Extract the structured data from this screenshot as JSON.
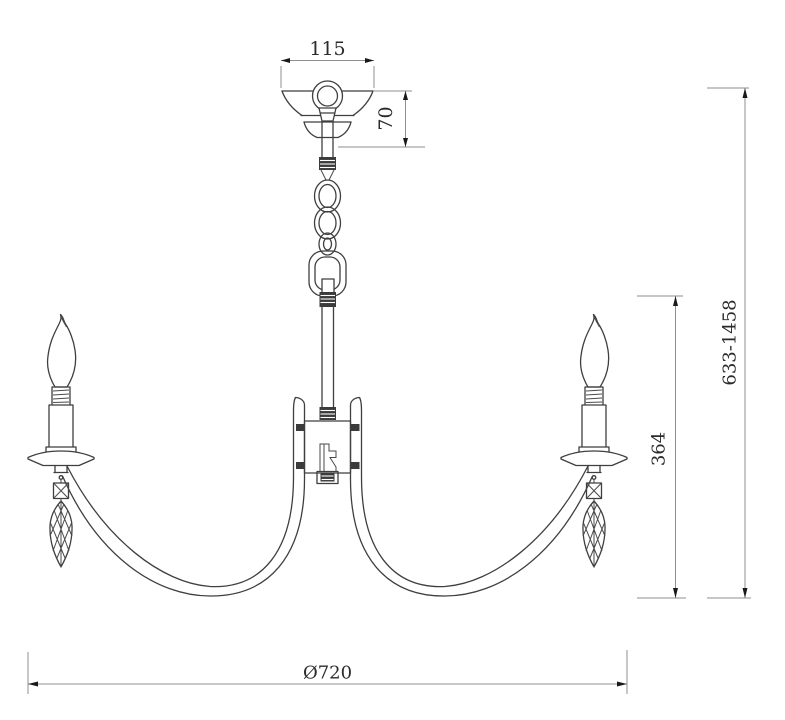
{
  "drawing": {
    "type": "technical-dimension-drawing",
    "subject": "two-arm candle chandelier, front elevation",
    "colors": {
      "background": "#ffffff",
      "outline": "#3f3f3f",
      "dimension_lines": "#8f8f8f",
      "arrowheads": "#1a1a1a",
      "text": "#2b2b2b"
    },
    "dimensions": {
      "canopy_width": "115",
      "canopy_height": "70",
      "overall_height_range": "633-1458",
      "body_height": "364",
      "diameter": "Ø720"
    }
  }
}
